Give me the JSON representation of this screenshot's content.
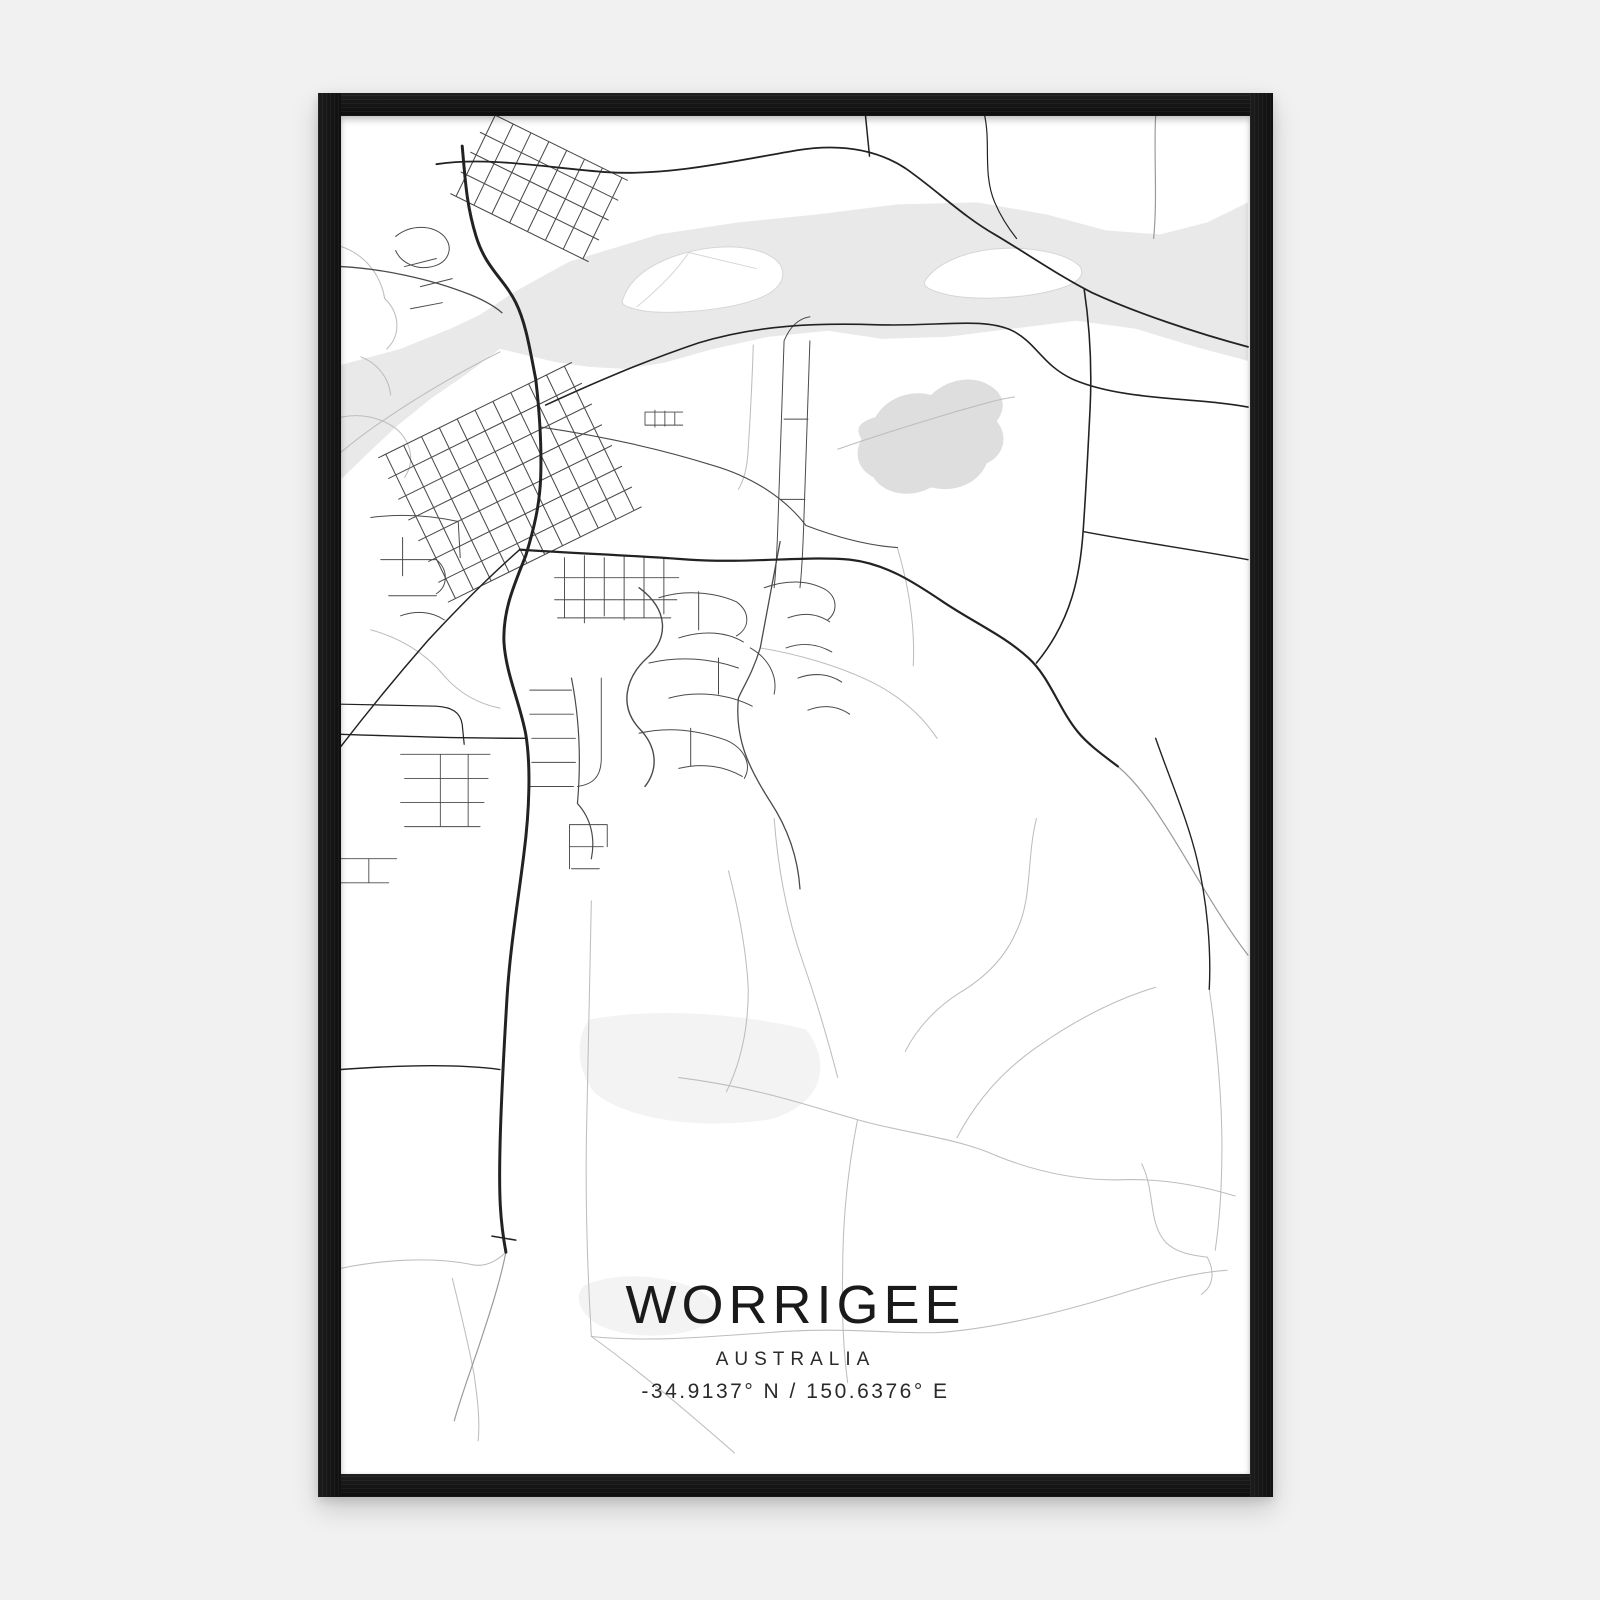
{
  "poster": {
    "title": "WORRIGEE",
    "country": "AUSTRALIA",
    "coordinates": "-34.9137° N / 150.6376° E"
  },
  "style": {
    "colors": {
      "background": "#f1f1f2",
      "frame": "#141414",
      "paper": "#ffffff",
      "water": "#e9e9e9",
      "reserve": "#dedede",
      "park_faint": "#f3f3f3",
      "road_major": "#222222",
      "road_medium": "#4a4a4a",
      "road_rural": "#bdbdbd",
      "road_faint": "#9a9a9a",
      "island_outline": "#d6d6d6",
      "text": "#1a1a1a"
    }
  }
}
